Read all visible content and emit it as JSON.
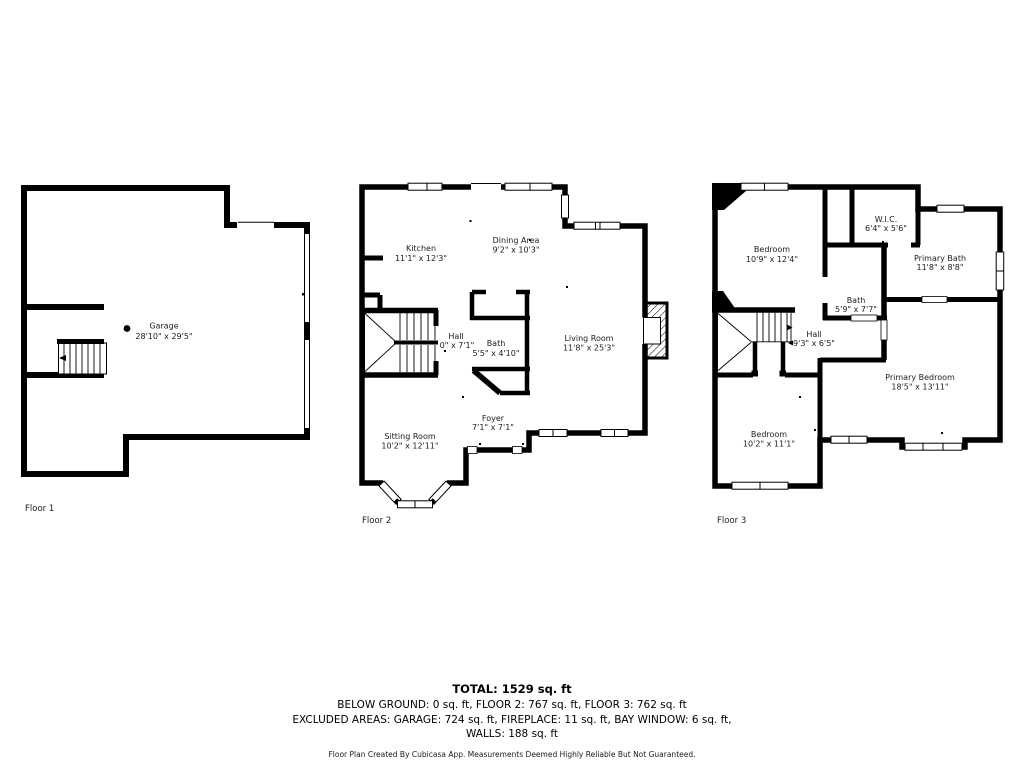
{
  "floors": [
    {
      "label": "Floor 1",
      "rooms": [
        {
          "name": "Garage",
          "dims": "28'10\" x 29'5\""
        }
      ]
    },
    {
      "label": "Floor 2",
      "rooms": [
        {
          "name": "Kitchen",
          "dims": "11'1\" x 12'3\""
        },
        {
          "name": "Dining Area",
          "dims": "9'2\" x 10'3\""
        },
        {
          "name": "Hall",
          "dims": "0\" x 7'1\""
        },
        {
          "name": "Bath",
          "dims": "5'5\" x 4'10\""
        },
        {
          "name": "Living Room",
          "dims": "11'8\" x 25'3\""
        },
        {
          "name": "Foyer",
          "dims": "7'1\" x 7'1\""
        },
        {
          "name": "Sitting Room",
          "dims": "10'2\" x 12'11\""
        }
      ]
    },
    {
      "label": "Floor 3",
      "rooms": [
        {
          "name": "Bedroom",
          "dims": "10'9\" x 12'4\""
        },
        {
          "name": "W.I.C.",
          "dims": "6'4\" x 5'6\""
        },
        {
          "name": "Primary Bath",
          "dims": "11'8\" x 8'8\""
        },
        {
          "name": "Bath",
          "dims": "5'9\" x 7'7\""
        },
        {
          "name": "Hall",
          "dims": "9'3\" x 6'5\""
        },
        {
          "name": "Primary Bedroom",
          "dims": "18'5\" x 13'11\""
        },
        {
          "name": "Bedroom",
          "dims": "10'2\" x 11'1\""
        }
      ]
    }
  ],
  "summary": {
    "total": "TOTAL: 1529 sq. ft",
    "floors_line": "BELOW GROUND: 0 sq. ft, FLOOR 2: 767 sq. ft, FLOOR 3: 762 sq. ft",
    "excluded_line": "EXCLUDED AREAS: GARAGE: 724 sq. ft, FIREPLACE: 11 sq. ft, BAY WINDOW: 6 sq. ft,",
    "walls_line": "WALLS: 188 sq. ft",
    "disclaimer": "Floor Plan Created By Cubicasa App. Measurements Deemed Highly Reliable But Not Guaranteed."
  },
  "colors": {
    "wall": "#000000",
    "text": "#1c1c1c",
    "background": "#ffffff"
  }
}
